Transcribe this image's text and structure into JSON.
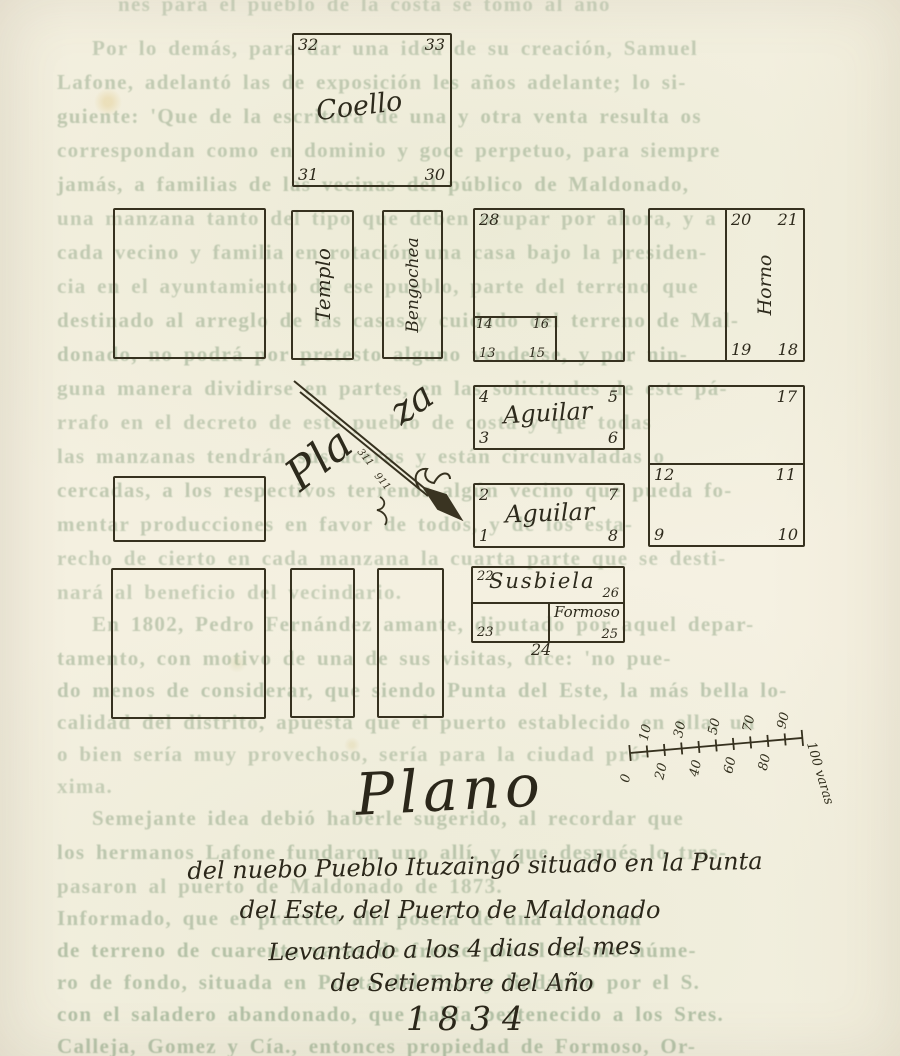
{
  "map": {
    "blocks": {
      "coello": {
        "label": "Coello",
        "corners": {
          "tl": "32",
          "tr": "33",
          "bl": "31",
          "br": "30"
        }
      },
      "templo": {
        "label": "Templo"
      },
      "bengochea": {
        "label": "Bengochea"
      },
      "block_28": {
        "corner_tl": "28",
        "inner_lots": {
          "tl": "14",
          "tr": "16",
          "bl": "13",
          "br": "15"
        }
      },
      "horno": {
        "label": "Horno",
        "corners": {
          "tl": "20",
          "tr": "21",
          "bl": "19",
          "br": "18"
        }
      },
      "aguilar_1": {
        "label": "Aguilar",
        "corners": {
          "tl": "4",
          "tr": "5",
          "bl": "3",
          "br": "6"
        }
      },
      "aguilar_2": {
        "label": "Aguilar",
        "corners": {
          "tl": "2",
          "tr": "7",
          "bl": "1",
          "br": "8"
        }
      },
      "east_block": {
        "upper_corner_tr": "17",
        "lower": {
          "tl": "12",
          "tr": "11",
          "bl": "9",
          "br": "10"
        }
      },
      "susbiela": {
        "label": "Susbiela",
        "corner_tl": "22",
        "corner_br": "26"
      },
      "formoso": {
        "label": "Formoso",
        "corner_bl": "23",
        "corner_br": "25",
        "below_label": "24"
      }
    },
    "plaza": {
      "part1": "Pla",
      "part2": "za",
      "arrow_marks": [
        "311",
        "911"
      ]
    },
    "scale_bar": {
      "ticks": [
        {
          "label": "0",
          "side": "below"
        },
        {
          "label": "10",
          "side": "above"
        },
        {
          "label": "20",
          "side": "below"
        },
        {
          "label": "30",
          "side": "above"
        },
        {
          "label": "40",
          "side": "below"
        },
        {
          "label": "50",
          "side": "above"
        },
        {
          "label": "60",
          "side": "below"
        },
        {
          "label": "70",
          "side": "above"
        },
        {
          "label": "80",
          "side": "below"
        },
        {
          "label": "90",
          "side": "above"
        },
        {
          "label": "100 varas",
          "side": "end"
        }
      ]
    }
  },
  "caption": {
    "title": "Plano",
    "lines": [
      "del nuebo Pueblo Ituzaingó  situado en la Punta",
      "del Este, del Puerto de Maldonado",
      "Levantado a los 4 dias del mes",
      "de Setiembre del Año"
    ],
    "year": "1834"
  },
  "bleed_text": {
    "lines": [
      {
        "y": -8,
        "x": 118,
        "o": 0.34,
        "text": "nes para el pueblo de la costa se tomó al año"
      },
      {
        "y": 36,
        "x": 92,
        "o": 0.4,
        "text": "Por lo demás, para dar una idea de su creación, Samuel"
      },
      {
        "y": 70,
        "x": 57,
        "o": 0.42,
        "text": "Lafone, adelantó las de exposición les años adelante; lo si-"
      },
      {
        "y": 104,
        "x": 57,
        "o": 0.44,
        "text": "guiente: 'Que de la escritura de una y otra venta resulta os"
      },
      {
        "y": 138,
        "x": 57,
        "o": 0.42,
        "text": "correspondan como en dominio y goce perpetuo, para siempre"
      },
      {
        "y": 172,
        "x": 57,
        "o": 0.44,
        "text": "jamás, a familias de las vecinas del público de Maldonado,"
      },
      {
        "y": 206,
        "x": 57,
        "o": 0.4,
        "text": "una manzana tanto del tipo que deben ocupar por ahora, y a"
      },
      {
        "y": 240,
        "x": 57,
        "o": 0.42,
        "text": "cada vecino y familia en rotación una casa bajo la presiden-"
      },
      {
        "y": 274,
        "x": 57,
        "o": 0.4,
        "text": "cia en el ayuntamiento de ese pueblo, parte del terreno que"
      },
      {
        "y": 308,
        "x": 57,
        "o": 0.44,
        "text": "destinado al arreglo de las casas y cuidado del terreno de Mal-"
      },
      {
        "y": 342,
        "x": 57,
        "o": 0.46,
        "text": "donado, no podrá por pretesto alguno venderse, y por nin-"
      },
      {
        "y": 376,
        "x": 57,
        "o": 0.42,
        "text": "guna manera dividirse en partes, en las solicitudes de este pá-"
      },
      {
        "y": 410,
        "x": 57,
        "o": 0.4,
        "text": "rrafo en el decreto de este pueblo de costa y que todas"
      },
      {
        "y": 444,
        "x": 57,
        "o": 0.42,
        "text": "las manzanas tendrán sus aceras y están circunvaladas o"
      },
      {
        "y": 478,
        "x": 57,
        "o": 0.44,
        "text": "cercadas, a los respectivos terrenos algún vecino que pueda fo-"
      },
      {
        "y": 512,
        "x": 57,
        "o": 0.42,
        "text": "mentar producciones en favor de todos, y de los esta-"
      },
      {
        "y": 546,
        "x": 57,
        "o": 0.4,
        "text": "recho de cierto en cada manzana la cuarta parte que se desti-"
      },
      {
        "y": 580,
        "x": 57,
        "o": 0.38,
        "text": "nará al beneficio del vecindario."
      },
      {
        "y": 612,
        "x": 92,
        "o": 0.44,
        "text": "En 1802, Pedro Fernández amante, diputado por aquel depar-"
      },
      {
        "y": 646,
        "x": 57,
        "o": 0.44,
        "text": "tamento, con motivo de una de sus visitas, dice: 'no pue-"
      },
      {
        "y": 678,
        "x": 57,
        "o": 0.46,
        "text": "do menos de considerar, que siendo Punta del Este, la más bella lo-"
      },
      {
        "y": 710,
        "x": 57,
        "o": 0.42,
        "text": "calidad del distrito, apuesta que el puerto establecido en ella, un"
      },
      {
        "y": 742,
        "x": 57,
        "o": 0.4,
        "text": "o bien sería muy provechoso, sería para la ciudad pró-"
      },
      {
        "y": 774,
        "x": 57,
        "o": 0.38,
        "text": "xima."
      },
      {
        "y": 806,
        "x": 92,
        "o": 0.44,
        "text": "Semejante idea debió haberle sugerido, al recordar que"
      },
      {
        "y": 840,
        "x": 57,
        "o": 0.46,
        "text": "los hermanos Lafone fundaron uno allí, y que después lo tras-"
      },
      {
        "y": 874,
        "x": 57,
        "o": 0.42,
        "text": "pasaron al puerto de Maldonado de 1873."
      },
      {
        "y": 906,
        "x": 57,
        "o": 0.46,
        "text": "Informado, que el práctico allí poseía de una Tracción"
      },
      {
        "y": 938,
        "x": 57,
        "o": 0.52,
        "text": "de terreno de cuarenta varas de frente por el mismo núme-"
      },
      {
        "y": 970,
        "x": 57,
        "o": 0.5,
        "text": "ro de fondo, situada en Punta del Este y lindando por el S."
      },
      {
        "y": 1002,
        "x": 57,
        "o": 0.54,
        "text": "con el saladero abandonado, que había pertenecido a los Sres."
      },
      {
        "y": 1034,
        "x": 57,
        "o": 0.52,
        "text": "Calleja, Gomez y Cía., entonces propiedad de Formoso, Or-"
      }
    ]
  }
}
